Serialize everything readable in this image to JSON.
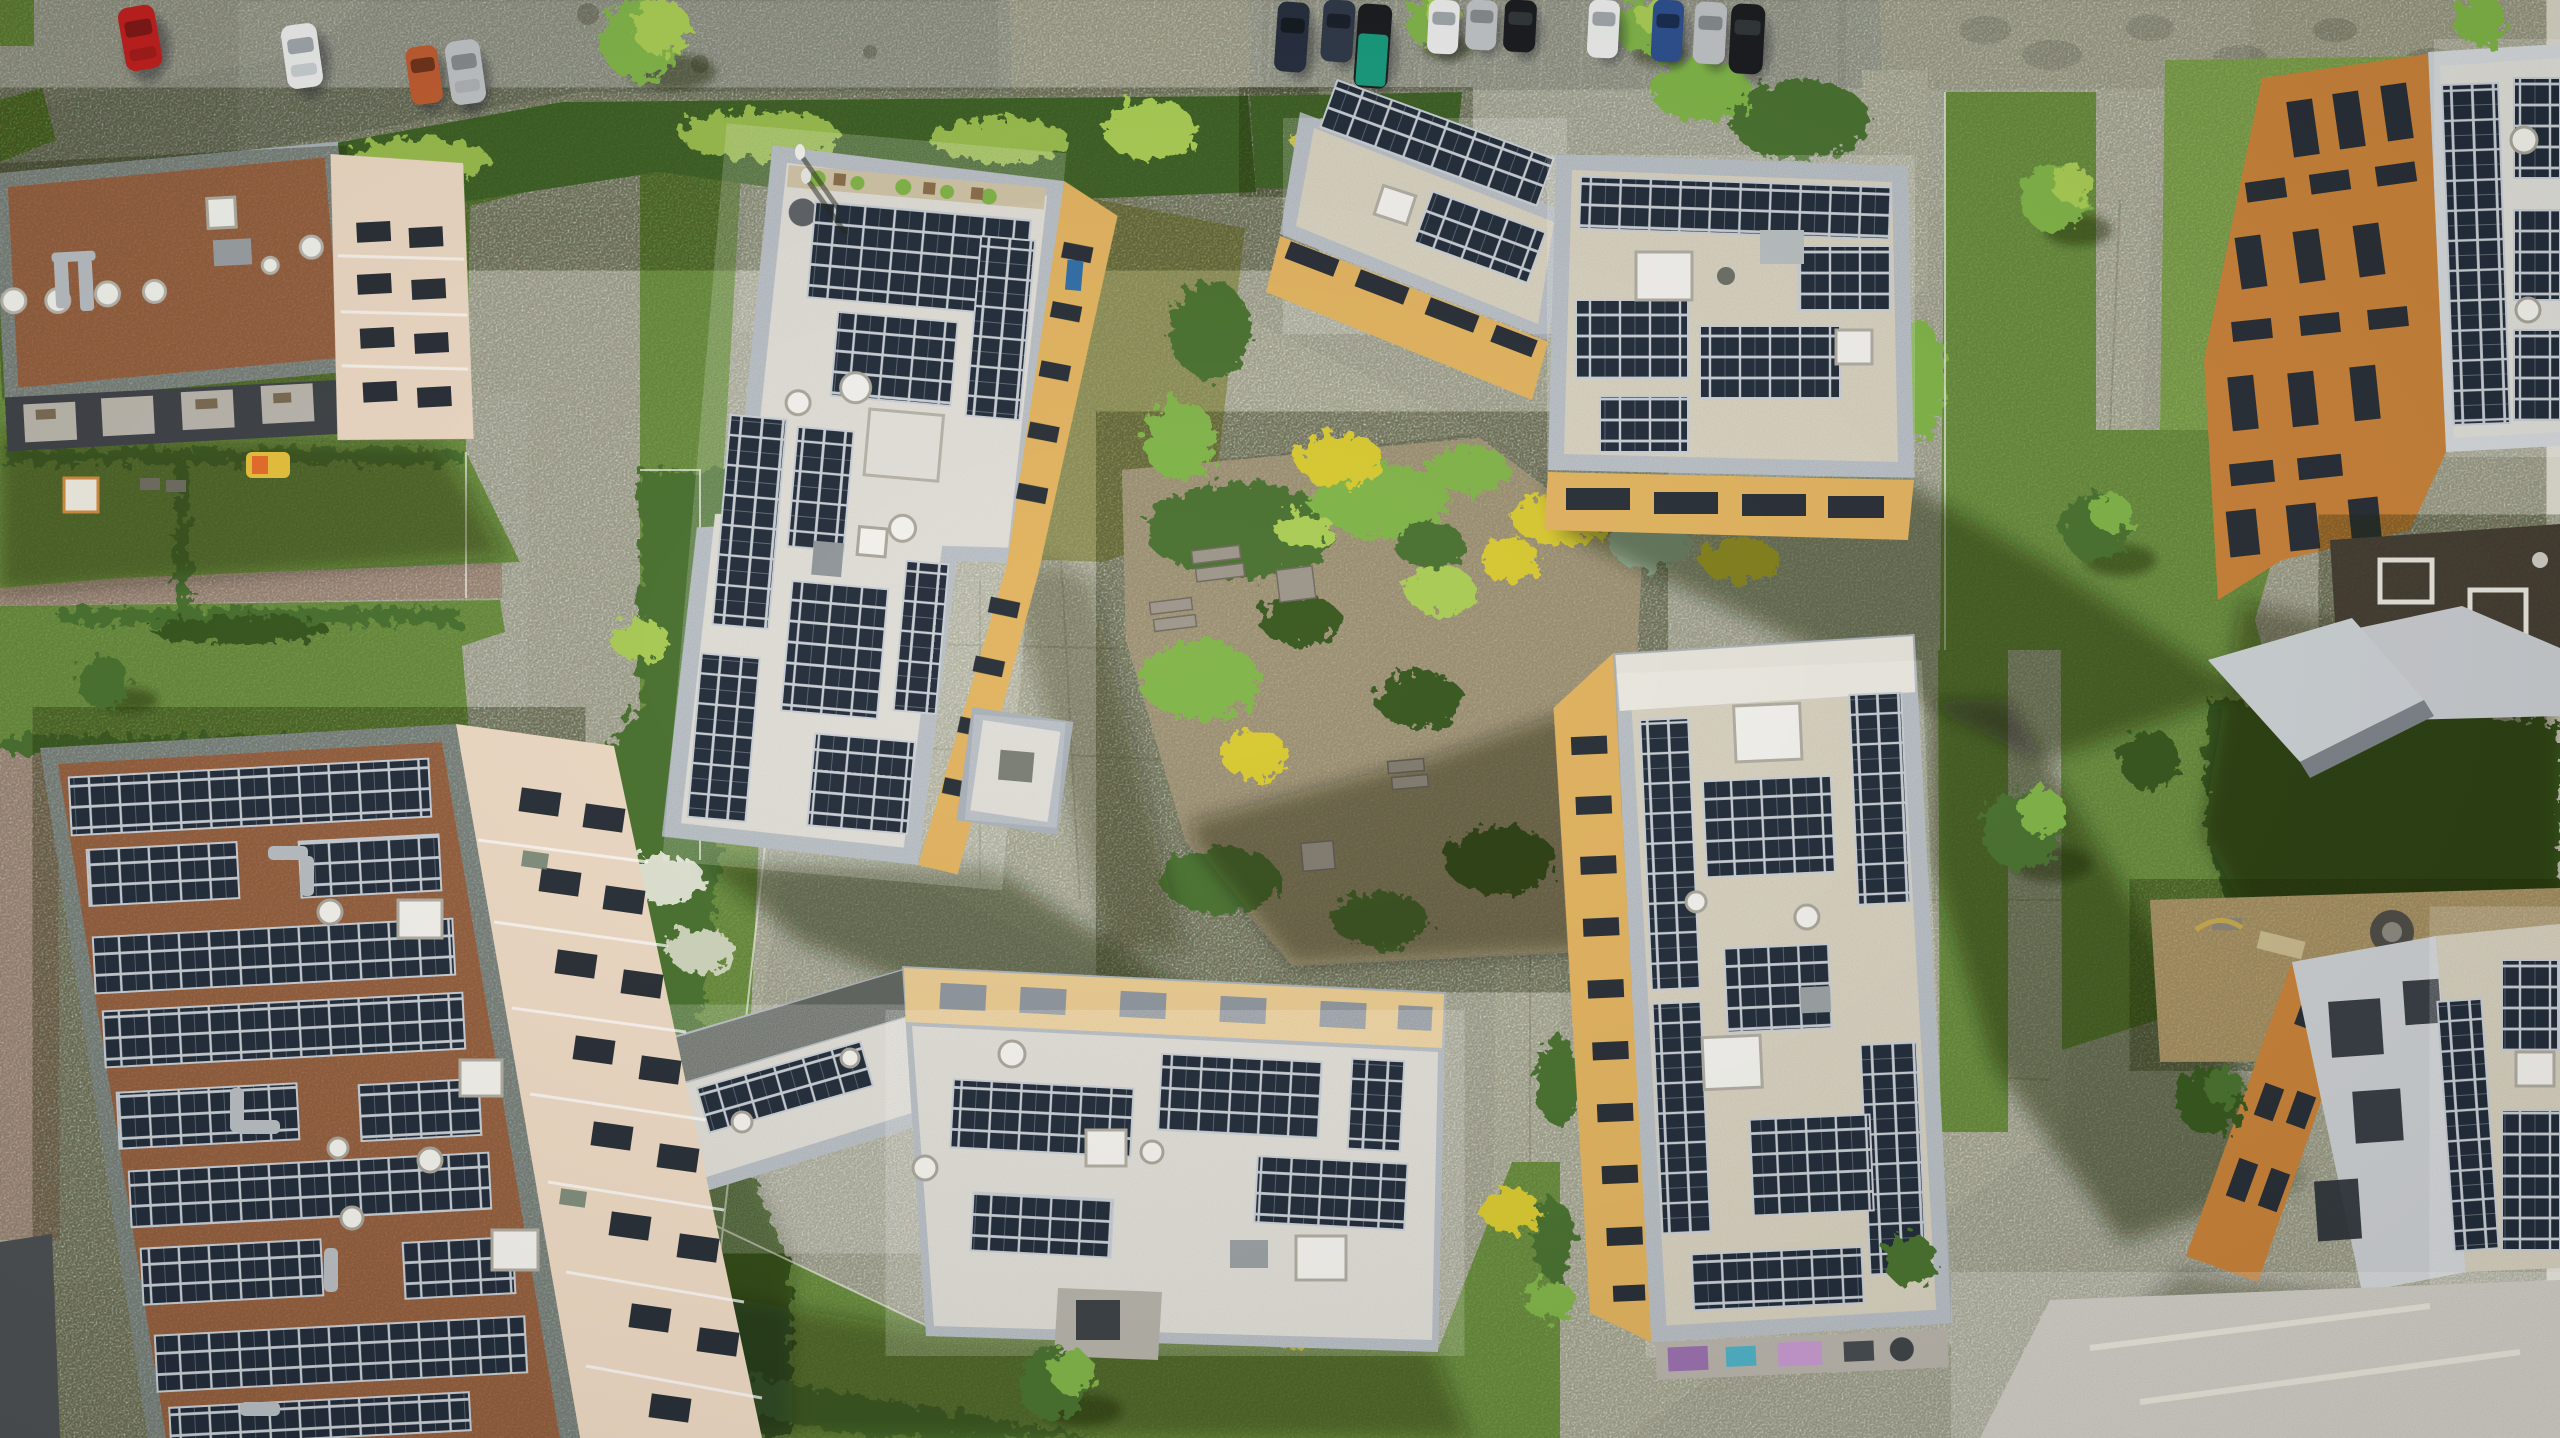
{
  "scene": {
    "description": "Top-down aerial drone photograph of a modern residential eco-quarter: apartment blocks with rooftop photovoltaic arrays, communal lawns, hedges, a sandy central courtyard garden, concrete footpaths, a street with parked cars along the top edge and a construction dirt area on the right.",
    "time_of_day": "sunny day, low sun, long soft shadows cast toward the lower right",
    "style": "orthographic nadir view with slight wide-angle lean of facades away from center"
  },
  "palette": {
    "concrete": "#d8d3c4",
    "concreteBright": "#eae6d8",
    "road": "#a9a7a3",
    "sidewalk": "#c7c5c0",
    "gravelPale": "#cfc8b6",
    "lawn": "#7ca54b",
    "lawnBright": "#93bb5b",
    "lawnDry": "#a7a96b",
    "hedge": "#47702e",
    "hedgeDark": "#34561f",
    "leaf": "#7fb446",
    "leafBright": "#a9cc52",
    "yellowBush": "#d8c92f",
    "sand": "#b9ab8b",
    "dirt": "#a8875c",
    "dirtPale": "#c2a876",
    "roofRed": "#af6f4e",
    "roofPale": "#d8d5cd",
    "roofTan": "#cdc4ad",
    "roofBrown": "#4f453c",
    "slopeDark": "#5d625c",
    "parapet": "#a8b0b8",
    "parapetPale": "#cdd2d7",
    "panel": "#202a39",
    "panelLine": "#8d98a6",
    "frame": "#c9cfd6",
    "amber": "#e2b35e",
    "orange": "#c98138",
    "beige": "#eedac5",
    "windowDark": "#262c35",
    "white": "#f4f3ef",
    "steel": "#b9bec4",
    "pink": "#d4a79e",
    "tarp": "#159a7d",
    "shadow": "rgba(24,32,14,0.45)",
    "shadowCool": "rgba(26,30,38,0.40)",
    "carRed": "#c11d1d",
    "carWhite": "#eceded",
    "carSilver": "#bfc3c7",
    "carBlack": "#16181c",
    "carBlue": "#2a4d8f",
    "carNavy": "#222b3c",
    "carOrange": "#bf5a2e"
  },
  "buildings": [
    {
      "id": "northwest-block",
      "roof": "red-brown gravel",
      "solar_arrays": false,
      "facade": "beige east face",
      "features": [
        "white dome vents",
        "silver duct pipes",
        "skylight",
        "dark roof terraces on south edge"
      ]
    },
    {
      "id": "west-block",
      "roof": "light gravel",
      "solar_arrays": true,
      "facade": "amber-yellow east face",
      "features": [
        "roof terrace garden with planters",
        "square skylights",
        "round vents",
        "annex roof"
      ]
    },
    {
      "id": "north-block",
      "roof": "tan gravel",
      "solar_arrays": true,
      "facade": "amber-yellow south face with dark window bands",
      "features": [
        "two angled wings",
        "skylights",
        "hvac unit"
      ]
    },
    {
      "id": "east-block",
      "roof": "tan gravel",
      "solar_arrays": true,
      "facade": "amber-yellow west face",
      "features": [
        "long slab",
        "skylight boxes",
        "balconies with household items at south end"
      ]
    },
    {
      "id": "south-block",
      "roof": "white gravel",
      "solar_arrays": true,
      "facade": "sand-yellow north face",
      "features": [
        "bent two-wing plan",
        "dark sloped wing roof",
        "dome vents",
        "entrance recess"
      ]
    },
    {
      "id": "southwest-block",
      "roof": "red-brown gravel",
      "solar_arrays": true,
      "facade": "rose-beige east face with window grid",
      "features": [
        "dense panel rows",
        "duct work",
        "dome vents"
      ]
    },
    {
      "id": "far-east-upper-block",
      "roof": "pale roof with solar rows plus dark brown roof section",
      "solar_arrays": true,
      "facade": "orange west face with window grid",
      "features": [
        "entrance canopy wedge"
      ]
    },
    {
      "id": "far-east-lower-block",
      "roof": "gravel with solar rows",
      "solar_arrays": true,
      "facade": "orange band and light gray face",
      "features": [
        "construction dirt apron",
        "debris"
      ]
    }
  ],
  "vehicles": {
    "street_west": [
      "red",
      "white",
      "dark orange",
      "silver"
    ],
    "north_parking": [
      "navy",
      "navy",
      "black with teal tarp",
      "white",
      "silver",
      "black",
      "white",
      "blue",
      "silver",
      "black"
    ]
  },
  "landscape": {
    "courtyard": "sandy planting beds with shrubs, yellow broom bushes and timber benches",
    "paths": "cast concrete slab walkways",
    "garden_paths_west": "rose-colored pavement",
    "hedges": "dense mixed shrub borders along street and gardens",
    "lawns": "communal green lawns with light wire fences",
    "trees": "young deciduous trees along paths and parking"
  }
}
